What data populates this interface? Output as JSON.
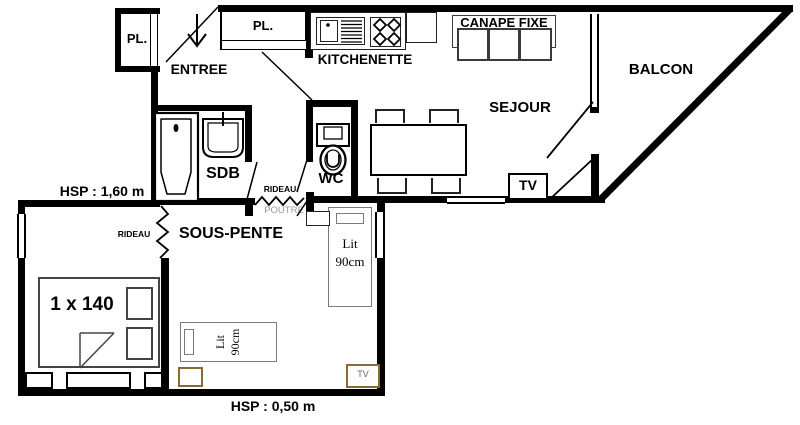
{
  "rooms": {
    "entree": {
      "label": "ENTREE"
    },
    "closet_entry": {
      "label": "PL."
    },
    "closet_hall": {
      "label": "PL."
    },
    "kitchenette": {
      "label": "KITCHENETTE"
    },
    "sejour": {
      "label": "SEJOUR"
    },
    "balcon": {
      "label": "BALCON"
    },
    "sdb": {
      "label": "SDB"
    },
    "wc": {
      "label": "WC"
    },
    "sous_pente": {
      "label": "SOUS-PENTE"
    }
  },
  "furniture": {
    "canape": {
      "label": "CANAPE FIXE"
    },
    "tv_sejour": {
      "label": "TV"
    },
    "tv_sous_pente": {
      "label": "TV"
    },
    "bed_double": {
      "label": "1 x 140"
    },
    "bed_single_nook": {
      "label": "Lit\n90cm"
    },
    "bed_single_bottom": {
      "label": "Lit\n90cm"
    }
  },
  "annotations": {
    "hsp_upper": {
      "label": "HSP : 1,60 m"
    },
    "hsp_lower": {
      "label": "HSP : 0,50 m"
    },
    "rideau_hall": {
      "label": "RIDEAU"
    },
    "rideau_bedroom": {
      "label": "RIDEAU"
    },
    "poutre": {
      "label": "POUTRE"
    }
  },
  "colors": {
    "wall": "#000000",
    "furniture_outline": "#3a3a3a",
    "bed_outline": "#7a7a7a",
    "wood_accent": "#8a6a33",
    "beam_text": "#9a9a9a",
    "background": "#ffffff"
  }
}
